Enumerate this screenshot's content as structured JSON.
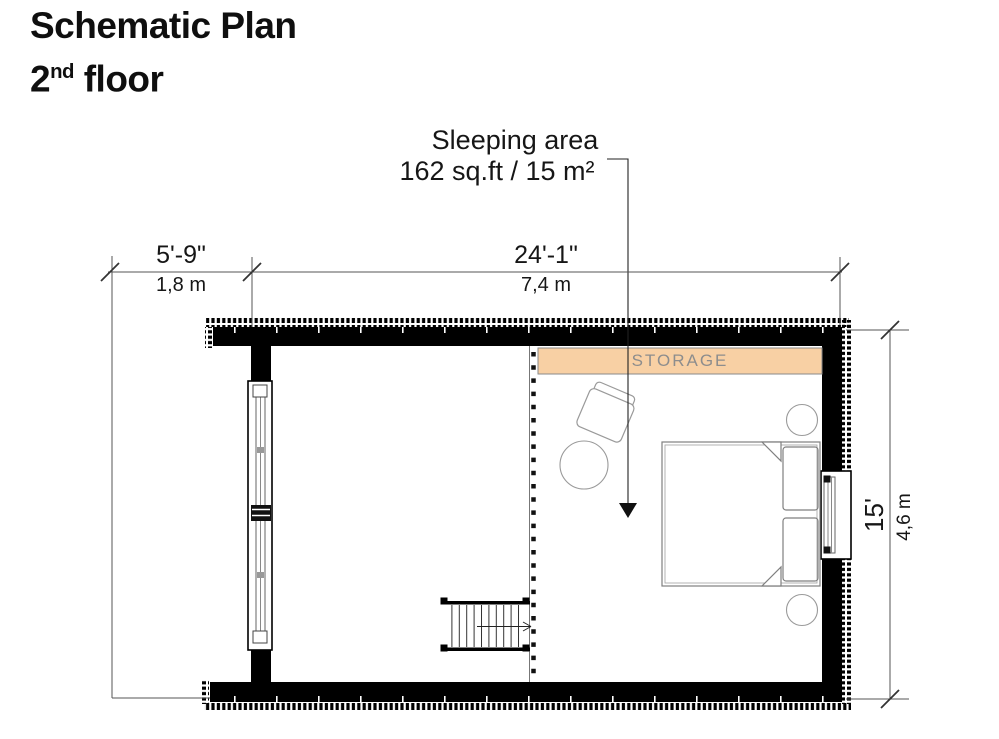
{
  "title": {
    "line1": "Schematic Plan",
    "floor_number": "2",
    "floor_ordinal": "nd",
    "floor_word": " floor"
  },
  "annotation": {
    "room_name": "Sleeping area",
    "room_area": "162 sq.ft / 15 m²"
  },
  "labels": {
    "storage": "STORAGE"
  },
  "dimensions": {
    "deck_width": {
      "imperial": "5'-9\"",
      "metric": "1,8 m"
    },
    "body_width": {
      "imperial": "24'-1\"",
      "metric": "7,4 m"
    },
    "body_depth": {
      "imperial": "15'",
      "metric": "4,6 m"
    }
  },
  "colors": {
    "wall": "#000000",
    "storage_fill": "#f8d0a4",
    "storage_border": "#8a8a8a",
    "storage_text": "#8d8d8d",
    "furniture_line": "#9a9a9a",
    "dimension_line": "#555555",
    "text": "#111111",
    "background": "#ffffff"
  }
}
